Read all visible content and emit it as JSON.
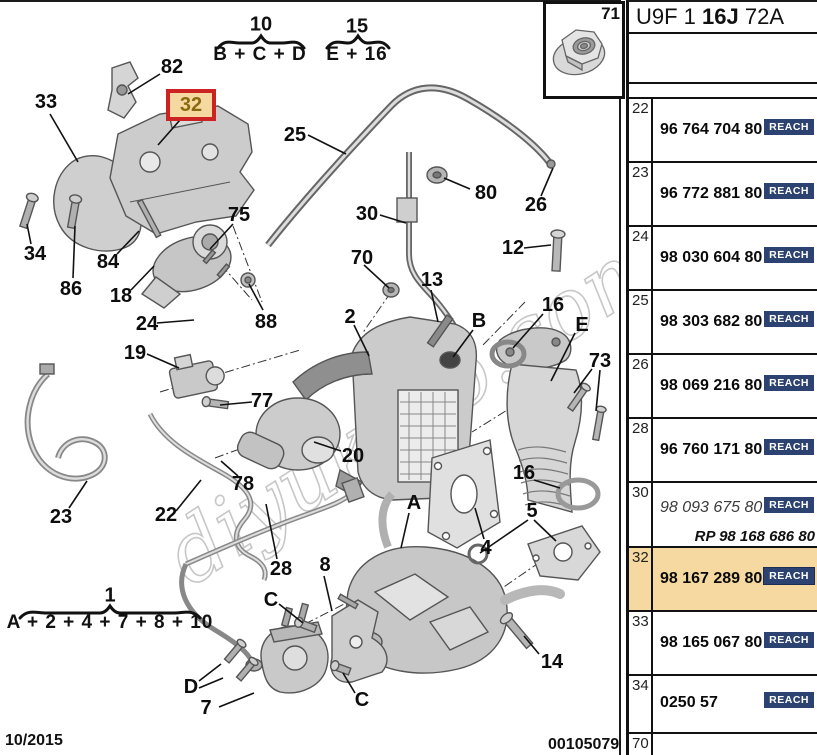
{
  "page": {
    "header_code": {
      "pre": "U9F 1 ",
      "bold": "16J",
      "post": " 72A"
    },
    "footer": {
      "date": "10/2015",
      "doc_number": "00105079"
    },
    "watermark": "diyukoto.com",
    "inset": {
      "ref": "71"
    }
  },
  "groups": {
    "g10": {
      "number": "10",
      "formula": "B + C + D"
    },
    "g15": {
      "number": "15",
      "formula": "E + 16"
    },
    "g1": {
      "number": "1",
      "formula": "A + 2 + 4 + 7 + 8 + 10"
    }
  },
  "highlighted_callout": {
    "label": "32"
  },
  "callouts": [
    {
      "label": "82"
    },
    {
      "label": "33"
    },
    {
      "label": "25"
    },
    {
      "label": "30"
    },
    {
      "label": "80"
    },
    {
      "label": "26"
    },
    {
      "label": "12"
    },
    {
      "label": "75"
    },
    {
      "label": "70"
    },
    {
      "label": "13"
    },
    {
      "label": "34"
    },
    {
      "label": "86"
    },
    {
      "label": "84"
    },
    {
      "label": "18"
    },
    {
      "label": "24"
    },
    {
      "label": "88"
    },
    {
      "label": "2"
    },
    {
      "label": "B"
    },
    {
      "label": "16"
    },
    {
      "label": "E"
    },
    {
      "label": "73"
    },
    {
      "label": "19"
    },
    {
      "label": "77"
    },
    {
      "label": "20"
    },
    {
      "label": "23"
    },
    {
      "label": "22"
    },
    {
      "label": "78"
    },
    {
      "label": "28"
    },
    {
      "label": "8"
    },
    {
      "label": "A"
    },
    {
      "label": "C"
    },
    {
      "label": "4"
    },
    {
      "label": "16"
    },
    {
      "label": "5"
    },
    {
      "label": "14"
    },
    {
      "label": "D"
    },
    {
      "label": "7"
    },
    {
      "label": "C"
    }
  ],
  "table": {
    "rows": [
      {
        "ref": "22",
        "part": "96 764 704 80",
        "badge": "REACH"
      },
      {
        "ref": "23",
        "part": "96 772 881 80",
        "badge": "REACH"
      },
      {
        "ref": "24",
        "part": "98 030 604 80",
        "badge": "REACH"
      },
      {
        "ref": "25",
        "part": "98 303 682 80",
        "badge": "REACH"
      },
      {
        "ref": "26",
        "part": "98 069 216 80",
        "badge": "REACH"
      },
      {
        "ref": "28",
        "part": "96 760 171 80",
        "badge": "REACH"
      },
      {
        "ref": "30",
        "part": "98 093 675 80",
        "badge": "REACH",
        "rp": "RP 98 168 686 80"
      },
      {
        "ref": "32",
        "part": "98 167 289 80",
        "badge": "REACH",
        "highlighted": true
      },
      {
        "ref": "33",
        "part": "98 165 067 80",
        "badge": "REACH"
      },
      {
        "ref": "34",
        "part": "0250 57",
        "badge": "REACH"
      },
      {
        "ref": "70",
        "part": "",
        "badge": ""
      }
    ]
  },
  "colors": {
    "highlight_bg": "#f6d9a1",
    "highlight_border": "#cc2222",
    "highlight_text": "#8a6a10",
    "reach_badge_bg": "#2c4270",
    "reach_badge_text": "#ffffff"
  }
}
